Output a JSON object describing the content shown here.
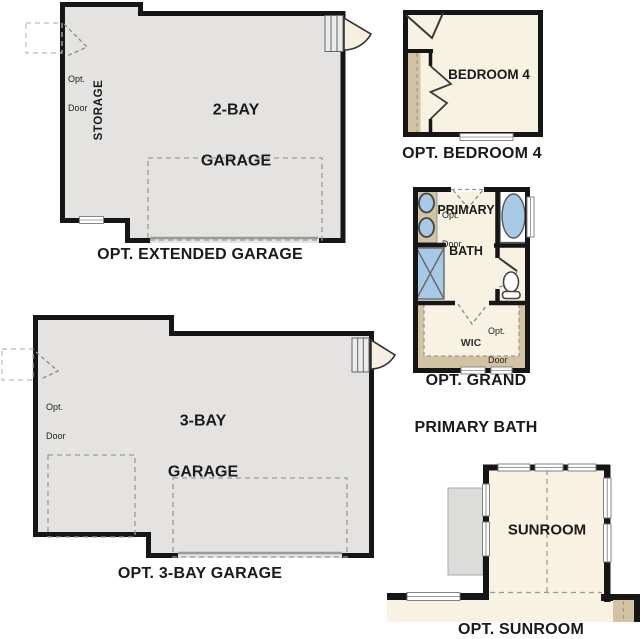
{
  "colors": {
    "wall": "#161616",
    "garage_fill": "#e4e3e1",
    "cream_fill": "#f8f2e3",
    "tan": "#d2c3a3",
    "fixture_blue": "#a8c8e8",
    "patio_gray": "#dcdcda",
    "dash_gray": "#9a9a9a",
    "door_leaf_fill": "#f7f0e1"
  },
  "shared": {
    "opt_door_line1": "Opt.",
    "opt_door_line2": "Door"
  },
  "extended_garage": {
    "caption": "OPT. EXTENDED GARAGE",
    "label_line1": "2-BAY",
    "label_line2": "GARAGE",
    "storage": "STORAGE"
  },
  "bedroom4": {
    "caption": "OPT. BEDROOM 4",
    "label": "BEDROOM 4"
  },
  "primary_bath": {
    "caption_line1": "OPT. GRAND",
    "caption_line2": "PRIMARY BATH",
    "label_line1": "PRIMARY",
    "label_line2": "BATH",
    "wic": "WIC"
  },
  "three_bay_garage": {
    "caption": "OPT. 3-BAY GARAGE",
    "label_line1": "3-BAY",
    "label_line2": "GARAGE"
  },
  "sunroom": {
    "caption": "OPT. SUNROOM",
    "label": "SUNROOM"
  }
}
